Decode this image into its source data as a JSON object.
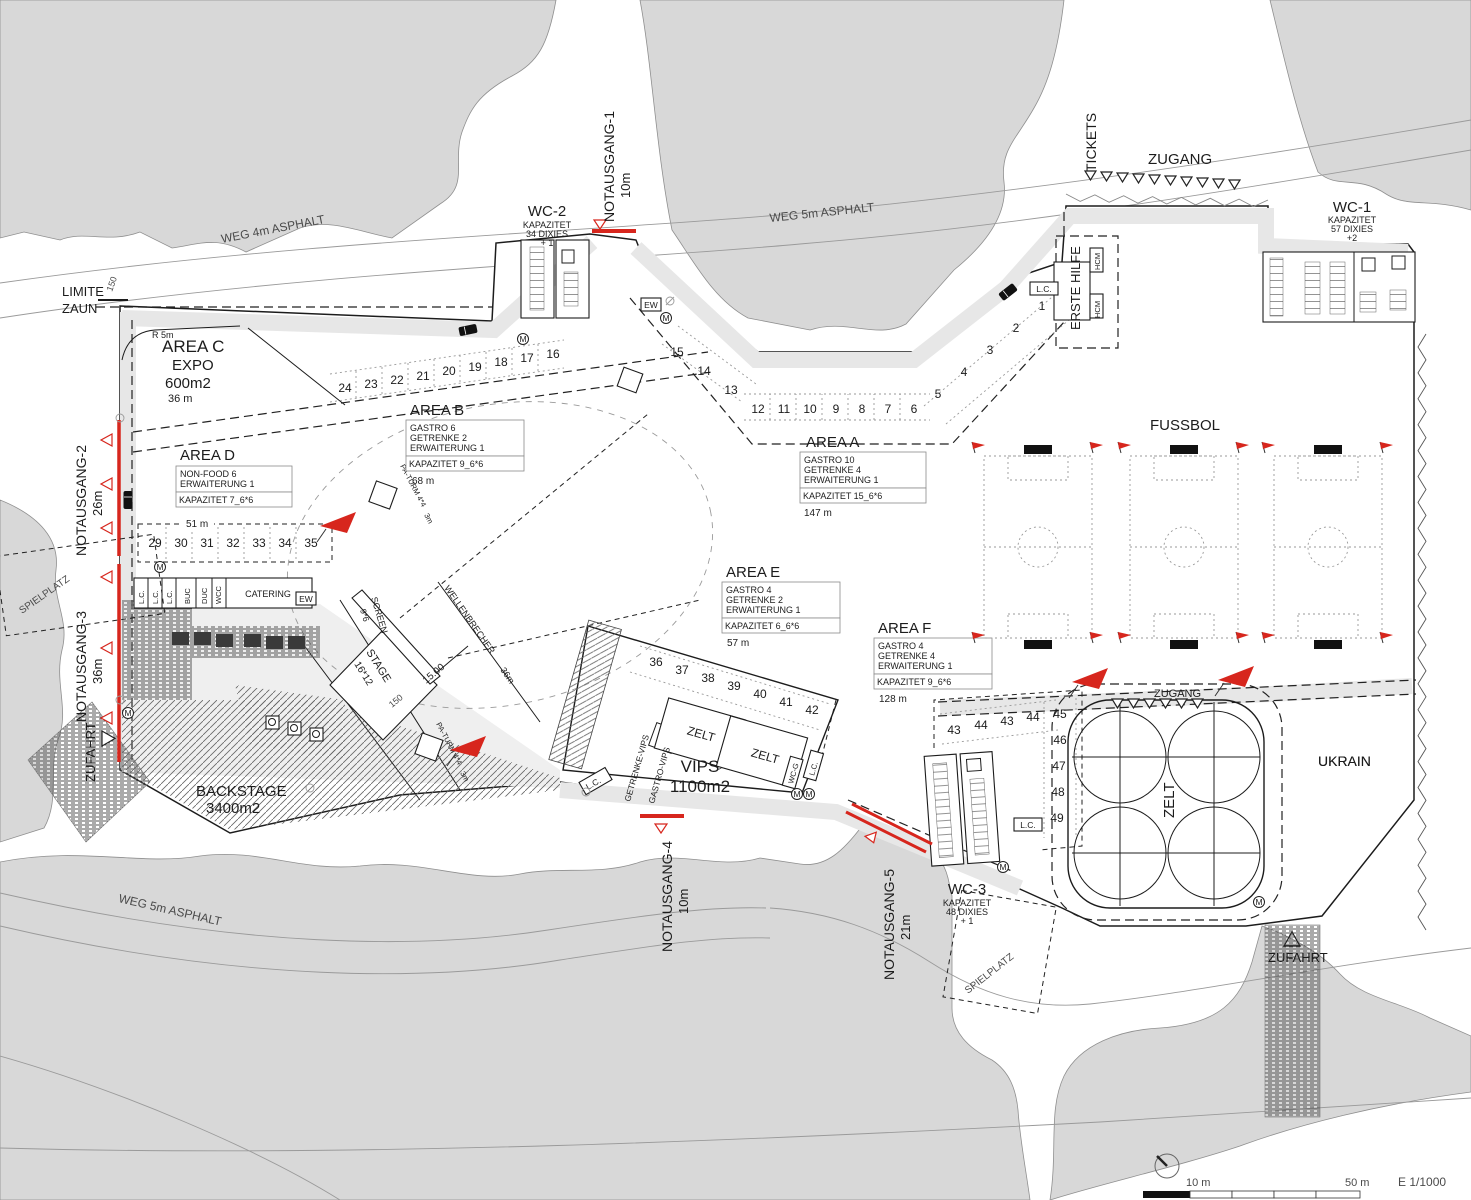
{
  "roads": {
    "weg4": "WEG 4m ASPHALT",
    "weg5_top": "WEG 5m ASPHALT",
    "weg5_bottom": "WEG 5m ASPHALT"
  },
  "fence": {
    "limite": "LIMITE",
    "zaun": "ZAUN",
    "level": "150",
    "r5": "R 5m"
  },
  "areas": {
    "a": {
      "title": "AREA A",
      "l1": "GASTRO 10",
      "l2": "GETRENKE 4",
      "l3": "ERWAITERUNG 1",
      "kap": "KAPAZITET 15_6*6",
      "len": "147 m"
    },
    "b": {
      "title": "AREA B",
      "l1": "GASTRO 6",
      "l2": "GETRENKE 2",
      "l3": "ERWAITERUNG 1",
      "kap": "KAPAZITET 9_6*6",
      "len": "68 m"
    },
    "c": {
      "title": "AREA C",
      "l1": "EXPO",
      "l2": "600m2",
      "len": "36 m"
    },
    "d": {
      "title": "AREA D",
      "l1": "NON-FOOD 6",
      "l2": "ERWAITERUNG 1",
      "kap": "KAPAZITET 7_6*6",
      "len": "51 m"
    },
    "e": {
      "title": "AREA E",
      "l1": "GASTRO 4",
      "l2": "GETRENKE 2",
      "l3": "ERWAITERUNG 1",
      "kap": "KAPAZITET 6_6*6",
      "len": "57 m"
    },
    "f": {
      "title": "AREA F",
      "l1": "GASTRO 4",
      "l2": "GETRENKE 4",
      "l3": "ERWAITERUNG 1",
      "kap": "KAPAZITET 9_6*6",
      "len": "128 m"
    }
  },
  "exits": {
    "n1": {
      "label": "NOTAUSGANG-1",
      "len": "10m"
    },
    "n2": {
      "label": "NOTAUSGANG-2",
      "len": "26m"
    },
    "n3": {
      "label": "NOTAUSGANG-3",
      "len": "36m"
    },
    "n4": {
      "label": "NOTAUSGANG-4",
      "len": "10m"
    },
    "n5": {
      "label": "NOTAUSGANG-5",
      "len": "21m"
    }
  },
  "wc": {
    "wc1": {
      "name": "WC-1",
      "l1": "KAPAZITET",
      "l2": "57 DIXIES",
      "l3": "+2"
    },
    "wc2": {
      "name": "WC-2",
      "l1": "KAPAZITET",
      "l2": "34 DIXIES",
      "l3": "+ 1"
    },
    "wc3": {
      "name": "WC-3",
      "l1": "KAPAZITET",
      "l2": "48 DIXIES",
      "l3": "+ 1"
    }
  },
  "gates": {
    "tickets": "TICKETS",
    "zugang_main": "ZUGANG",
    "zugang_zelt": "ZUGANG",
    "erste_hilfe": "ERSTE HILFE",
    "hcm": "HCM",
    "zufahrt_left": "ZUFAHRT",
    "zufahrt_right": "ZUFAHRT"
  },
  "zones": {
    "fussbol": "FUSSBOL",
    "ukrain": "UKRAIN",
    "zelt": "ZELT",
    "vips": "VIPS",
    "vips_size": "1100m2",
    "backstage": "BACKSTAGE",
    "backstage_size": "3400m2",
    "spielplatz": "SPIELPLATZ",
    "catering": "CATERING"
  },
  "vip": {
    "getrenke": "GETRENKE-VIPS",
    "gastro": "GASTRO-VIPS",
    "wcg": "WC-G"
  },
  "tech": {
    "stage": "STAGE",
    "stage_size": "16*12",
    "screen": "SCREEN",
    "screen_size": "9*6",
    "wellen": "WELLENBRECHER",
    "wellen_size": "36m",
    "paturm": "PA-TURM 4*4",
    "paturm_h": "3m"
  },
  "misc": {
    "lc": "L.C.",
    "ew": "EW",
    "m": "M",
    "buc": "BUC",
    "duc": "DUC",
    "wcc": "WCC",
    "dim15": "15.00",
    "dim150": "150"
  },
  "stands": {
    "ne": [
      "1",
      "2",
      "3",
      "4",
      "5"
    ],
    "bay_left": [
      "15",
      "14",
      "13"
    ],
    "bay_bottom": [
      "12",
      "11",
      "10",
      "9",
      "8",
      "7",
      "6"
    ],
    "top": [
      "24",
      "23",
      "22",
      "21",
      "20",
      "19",
      "18",
      "17",
      "16"
    ],
    "d": [
      "29",
      "30",
      "31",
      "32",
      "33",
      "34",
      "35"
    ],
    "e": [
      "36",
      "37",
      "38",
      "39",
      "40",
      "41",
      "42"
    ],
    "f_top": [
      "43",
      "44",
      "43",
      "44"
    ],
    "f_col": [
      "45",
      "46",
      "47",
      "48",
      "49"
    ]
  },
  "scale": {
    "m10": "10 m",
    "m50": "50 m",
    "ratio": "E 1/1000"
  }
}
